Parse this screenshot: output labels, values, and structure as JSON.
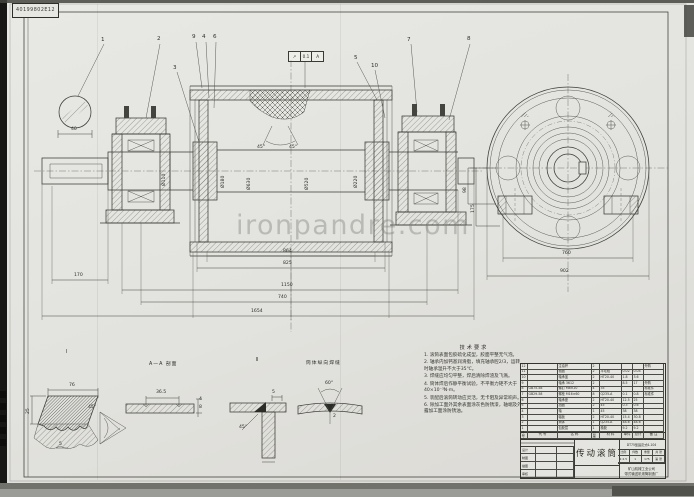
{
  "scan": {
    "stamp": "40199802E12",
    "watermark": "ironpandre.com"
  },
  "tolerance": {
    "symbol": "↗",
    "value": "0.1",
    "datum": "A"
  },
  "callouts": [
    {
      "n": "1",
      "x": 101,
      "y": 38
    },
    {
      "n": "2",
      "x": 157,
      "y": 37
    },
    {
      "n": "9",
      "x": 192,
      "y": 35
    },
    {
      "n": "4",
      "x": 202,
      "y": 35
    },
    {
      "n": "6",
      "x": 213,
      "y": 35
    },
    {
      "n": "3",
      "x": 173,
      "y": 66
    },
    {
      "n": "5",
      "x": 354,
      "y": 56
    },
    {
      "n": "10",
      "x": 371,
      "y": 64
    },
    {
      "n": "7",
      "x": 407,
      "y": 38
    },
    {
      "n": "8",
      "x": 467,
      "y": 37
    }
  ],
  "dims": [
    {
      "v": "864",
      "x": 283,
      "y": 250
    },
    {
      "v": "825",
      "x": 283,
      "y": 262
    },
    {
      "v": "170",
      "x": 74,
      "y": 274
    },
    {
      "v": "1150",
      "x": 281,
      "y": 284
    },
    {
      "v": "740",
      "x": 278,
      "y": 296
    },
    {
      "v": "1654",
      "x": 251,
      "y": 310
    },
    {
      "v": "40",
      "x": 71,
      "y": 128
    },
    {
      "v": "45°",
      "x": 257,
      "y": 146
    },
    {
      "v": "45°",
      "x": 289,
      "y": 146
    },
    {
      "v": "Ø110",
      "x": 163,
      "y": 186,
      "rot": 1
    },
    {
      "v": "Ø180",
      "x": 222,
      "y": 188,
      "rot": 1
    },
    {
      "v": "Ø630",
      "x": 248,
      "y": 190,
      "rot": 1
    },
    {
      "v": "Ø520",
      "x": 306,
      "y": 190,
      "rot": 1
    },
    {
      "v": "Ø220",
      "x": 355,
      "y": 188,
      "rot": 1
    },
    {
      "v": "760",
      "x": 562,
      "y": 252
    },
    {
      "v": "902",
      "x": 560,
      "y": 270
    },
    {
      "v": "98",
      "x": 464,
      "y": 193,
      "rot": 1
    },
    {
      "v": "175",
      "x": 472,
      "y": 213,
      "rot": 1
    },
    {
      "v": "76",
      "x": 69,
      "y": 384
    },
    {
      "v": "25",
      "x": 27,
      "y": 414,
      "rot": 1
    },
    {
      "v": "45°",
      "x": 88,
      "y": 406
    },
    {
      "v": "5",
      "x": 59,
      "y": 443
    },
    {
      "v": "36.5",
      "x": 156,
      "y": 391
    },
    {
      "v": "4",
      "x": 199,
      "y": 398
    },
    {
      "v": "8",
      "x": 199,
      "y": 406
    },
    {
      "v": "5",
      "x": 272,
      "y": 391
    },
    {
      "v": "45°",
      "x": 239,
      "y": 426
    },
    {
      "v": "60°",
      "x": 325,
      "y": 382
    },
    {
      "v": "2",
      "x": 333,
      "y": 415
    }
  ],
  "detail_labels": [
    {
      "t": "I",
      "x": 66,
      "y": 351
    },
    {
      "t": "A—A 剖面",
      "x": 149,
      "y": 363
    },
    {
      "t": "Ⅱ",
      "x": 256,
      "y": 359
    },
    {
      "t": "筒体纵向焊缝",
      "x": 306,
      "y": 362
    }
  ],
  "notes": {
    "title": "技术要求",
    "items": [
      "1. 滚筒表面包胶硫化成型，胶面平整无气泡。",
      "2. 轴承内加钙基润滑脂，填充轴承腔2/3，运转时轴承温升不大于35℃。",
      "3. 焊缝应均匀平整，焊后清除焊渣及飞溅。",
      "4. 筒体焊后作静平衡试验，不平衡力矩不大于40×10⁻³N·m。",
      "5. 装配后滚筒转动应灵活，无卡阻及异常响声。",
      "6. 除加工面外其余表面涂灰色防锈漆，轴端及外露加工面涂防锈油。"
    ]
  },
  "bom": {
    "headers": [
      "序号",
      "代  号",
      "名  称",
      "数量",
      "材  料",
      "单件",
      "总计",
      "备  注"
    ],
    "rows": [
      [
        "12",
        "",
        "注油杯",
        "2",
        "",
        "",
        "",
        "外购"
      ],
      [
        "11",
        "",
        "毡圈",
        "2",
        "羊毛毡",
        "0.02",
        "0.04",
        ""
      ],
      [
        "10",
        "",
        "轴承盖",
        "2",
        "HT20-40",
        "1.8",
        "3.6",
        ""
      ],
      [
        "9",
        "",
        "轴承 3612",
        "2",
        "",
        "8.5",
        "17",
        "外购"
      ],
      [
        "8",
        "GB75-58",
        "螺钉 M8×20",
        "4",
        "35",
        "",
        "",
        "标准件"
      ],
      [
        "7",
        "GB29-58",
        "螺栓 M16×60",
        "8",
        "Q235-A",
        "0.1",
        "0.8",
        "标准件"
      ],
      [
        "6",
        "",
        "轴承座",
        "2",
        "HT20-40",
        "12.5",
        "25",
        ""
      ],
      [
        "5",
        "",
        "挡圈",
        "2",
        "45",
        "0.3",
        "0.6",
        ""
      ],
      [
        "4",
        "",
        "轴",
        "1",
        "45",
        "38",
        "38",
        ""
      ],
      [
        "3",
        "",
        "辐板",
        "2",
        "HT20-40",
        "15.4",
        "30.8",
        ""
      ],
      [
        "2",
        "",
        "筒体",
        "1",
        "Q235-A",
        "48.6",
        "48.6",
        ""
      ],
      [
        "1",
        "",
        "包胶层",
        "1",
        "橡胶",
        "9.2",
        "9.2",
        ""
      ]
    ]
  },
  "titleblock": {
    "title": "传动滚筒",
    "code": "DT75型固定式4-104",
    "info_labels": [
      "比例",
      "件数",
      "重量",
      "共 张"
    ],
    "info_values": [
      "1:2.5",
      "1",
      "175",
      "第 张"
    ],
    "company": [
      "矿山机械工业公司",
      "带式输送机滚筒制造厂"
    ],
    "sign_rows": [
      [
        "设计",
        "",
        ""
      ],
      [
        "制图",
        "",
        ""
      ],
      [
        "描图",
        "",
        ""
      ],
      [
        "审核",
        "",
        ""
      ]
    ]
  }
}
